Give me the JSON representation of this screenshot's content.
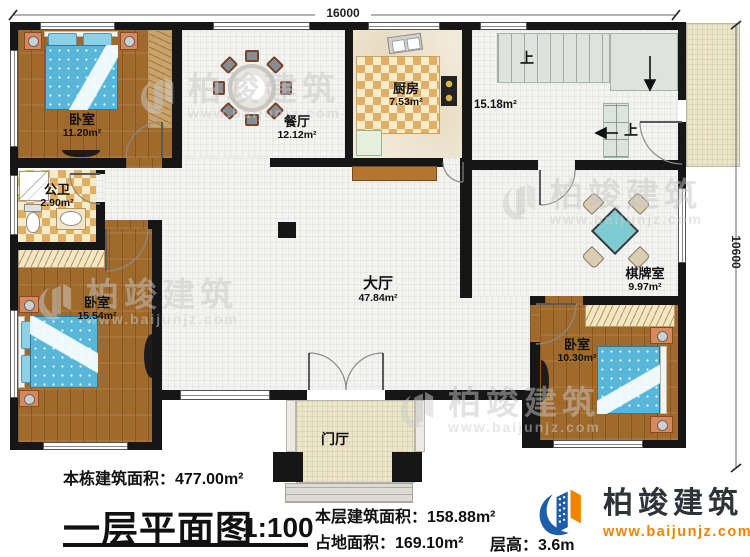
{
  "dimensions": {
    "top": "16000",
    "right": "10600"
  },
  "rooms": {
    "bedroom1": {
      "name": "卧室",
      "area": "11.20m²"
    },
    "dining": {
      "name": "餐厅",
      "area": "12.12m²"
    },
    "kitchen": {
      "name": "厨房",
      "area": "7.53m²"
    },
    "stair_hall": {
      "area": "15.18m²"
    },
    "bathroom": {
      "name": "公卫",
      "area": "2.90m²"
    },
    "bedroom2": {
      "name": "卧室",
      "area": "15.54m²"
    },
    "hall": {
      "name": "大厅",
      "area": "47.84m²"
    },
    "chess_room": {
      "name": "棋牌室",
      "area": "9.97m²"
    },
    "bedroom3": {
      "name": "卧室",
      "area": "10.30m²"
    },
    "foyer": {
      "name": "门厅"
    }
  },
  "stairs": {
    "up_label": "上"
  },
  "title_block": {
    "building_total": "本栋建筑面积：477.00m²",
    "plan_title": "一层平面图",
    "scale": "1:100",
    "floor_area": "本层建筑面积：158.88m²",
    "land_area": "占地面积：169.10m²",
    "floor_height": "层高：3.6m"
  },
  "brand": {
    "name": "柏竣建筑",
    "url": "www.baijunjz.com"
  },
  "watermark": {
    "name": "柏竣建筑",
    "url": "www.baijunjz.com"
  },
  "colors": {
    "wall": "#161616",
    "wood": "#a06a2c",
    "bed_blue": "#58b7d8",
    "logo_blue": "#1c5ea9",
    "logo_orange": "#f08300"
  }
}
